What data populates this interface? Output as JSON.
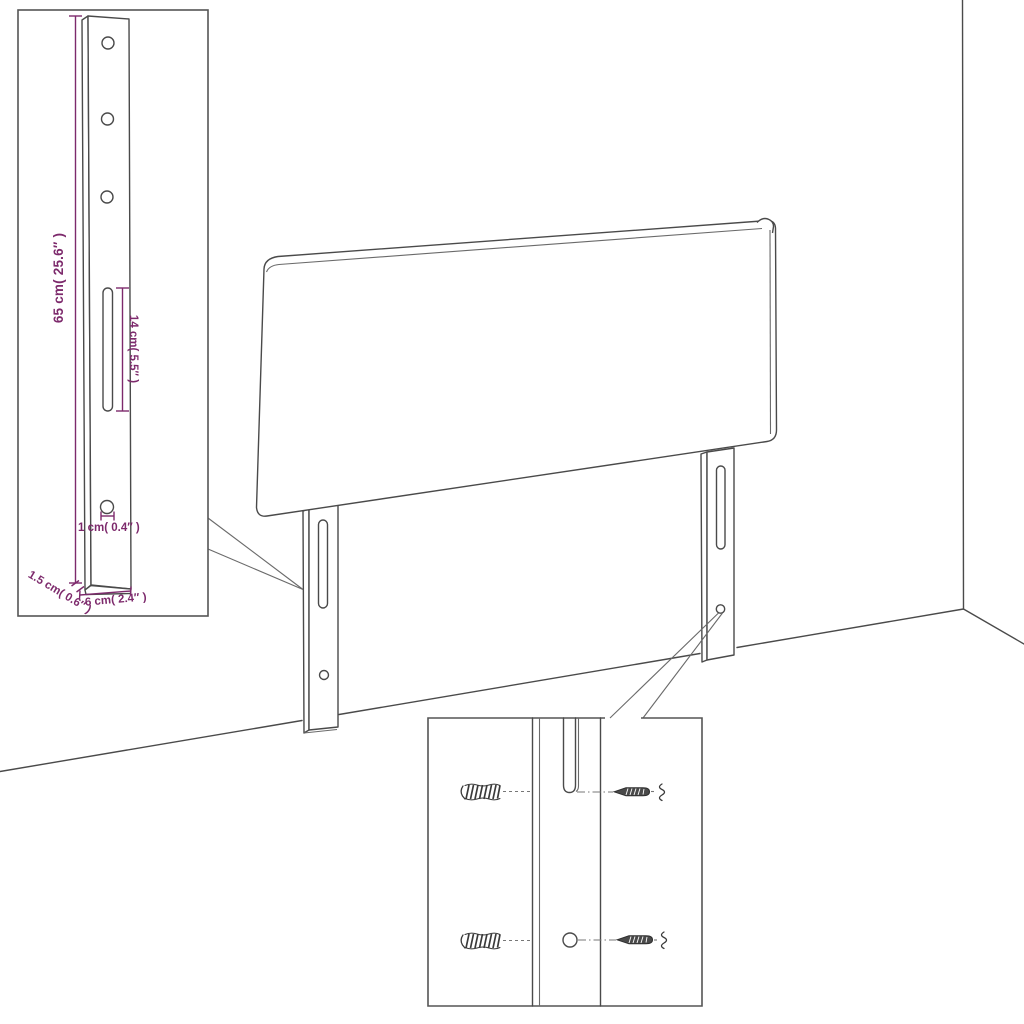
{
  "meta": {
    "type": "product-assembly-diagram",
    "subject": "upholstered headboard with two mounting legs, wall corner scene"
  },
  "colors": {
    "background": "#ffffff",
    "line_art": "#4a4a4a",
    "accent_dimension": "#7d2a6c",
    "callout_border": "#555555"
  },
  "dimensions": {
    "height": "65 cm( 25.6″ )",
    "slot": "14 cm( 5.5″ )",
    "hole": "1 cm( 0.4″ )",
    "thickness": "1.5 cm( 0.6″ )",
    "width": "6 cm( 2.4″ )"
  },
  "icons": {
    "wall_plug": "wall-plug",
    "screw": "screw",
    "mounting_leg": "mounting-leg-bracket"
  }
}
